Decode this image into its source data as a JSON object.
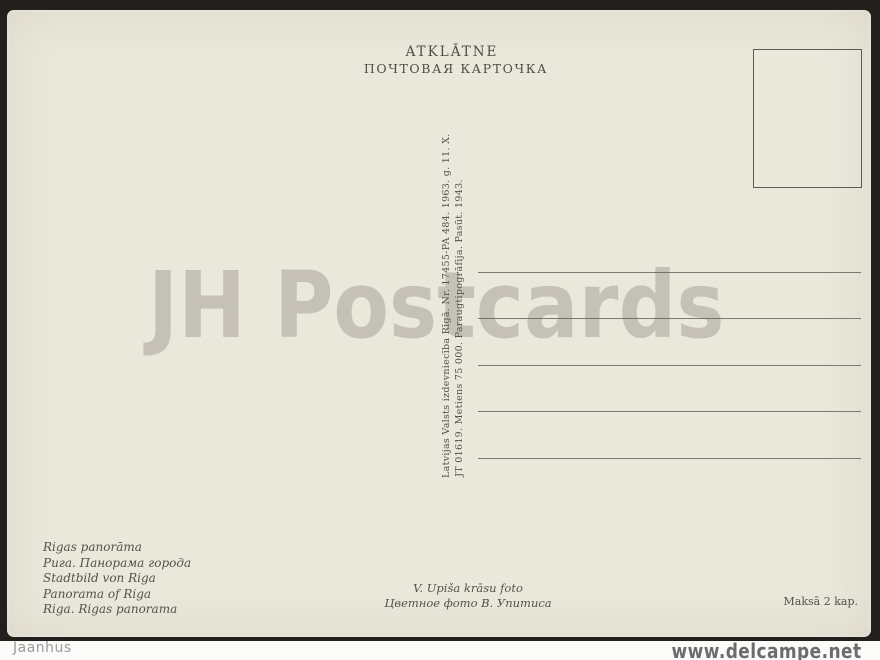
{
  "card": {
    "header": {
      "title_lv": "ATKLĀTNE",
      "title_ru": "ПОЧТОВАЯ КАРТОЧКА"
    },
    "publisher_imprint": {
      "line1": "Latvijas Valsts izdevniecība Rīgā. Nr. 17455-PA 484. 1963. g. 11. X.",
      "line2": "JT 01619. Metiens 75 000. Paraugtipogrāfija. Pasūt. 1943."
    },
    "captions": [
      "Rigas panorāma",
      "Рига. Панорама города",
      "Stadtbild von Riga",
      "Panorama of Riga",
      "Riga. Rigas panorama"
    ],
    "photo_credit": {
      "line1": "V. Upiša krāsu foto",
      "line2": "Цветное фото В. Упитиса"
    },
    "price": "Maksā 2 kap."
  },
  "watermark": "JH Postcards",
  "footer": {
    "left": "Jaanhus",
    "right": "www.delcampe.net"
  },
  "colors": {
    "card_bg": "#eae7db",
    "ink": "#55514a",
    "frame": "#21201c",
    "watermark_gray": "#cfccc2",
    "footer_gray": "#9c9c9c"
  }
}
